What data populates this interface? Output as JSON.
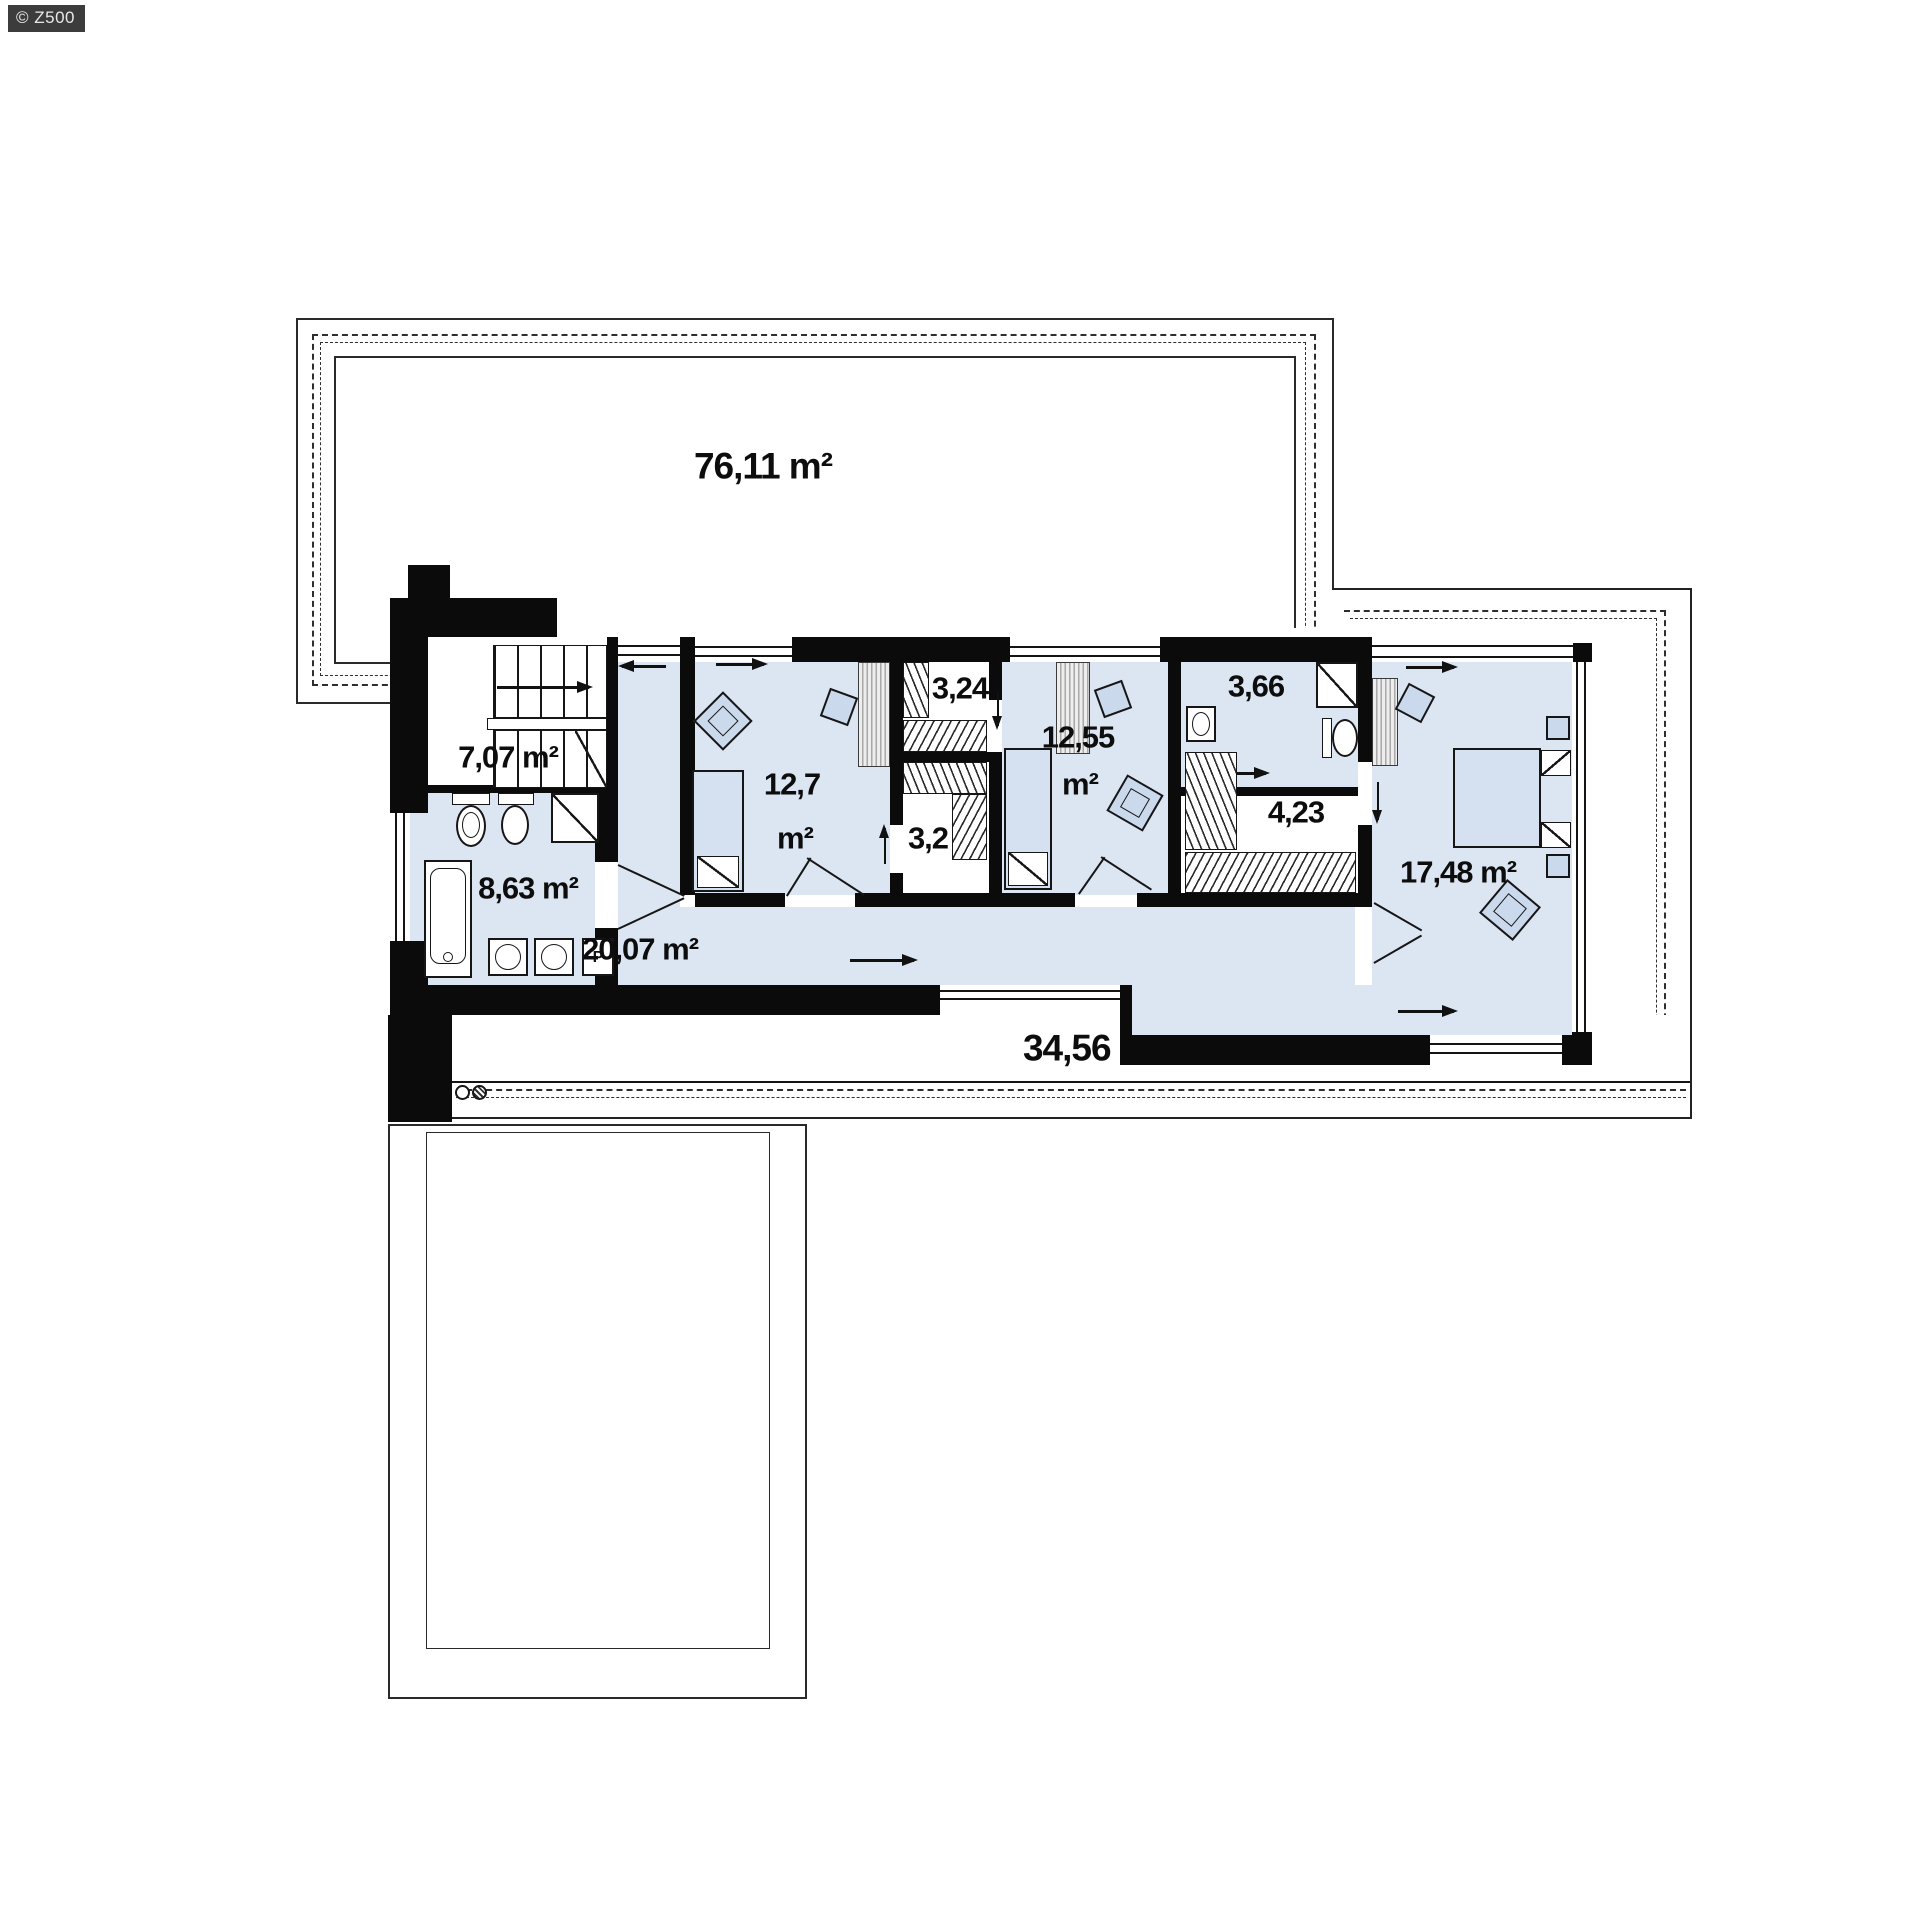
{
  "watermark": "© Z500",
  "plan": {
    "areas": {
      "roof_terrace_top": "76,11 m²",
      "staircase": "7,07 m²",
      "bathroom_left": "8,63 m²",
      "corridor": "20,07 m²",
      "bedroom_left_value": "12,7",
      "bedroom_left_unit": "m²",
      "wardrobe_a": "3,24",
      "wardrobe_b": "3,2",
      "bedroom_mid_value": "12,55",
      "bedroom_mid_unit": "m²",
      "bathroom_right": "3,66",
      "wardrobe_c": "4,23",
      "bedroom_master": "17,48 m²",
      "terrace_bottom": "34,56 m²",
      "washing_machine": "P"
    },
    "colors": {
      "room_fill": "#dce5f2",
      "furniture_fill": "#cbd9ed",
      "wall": "#0b0b0b",
      "watermark_bg": "#3c3c3c"
    }
  }
}
